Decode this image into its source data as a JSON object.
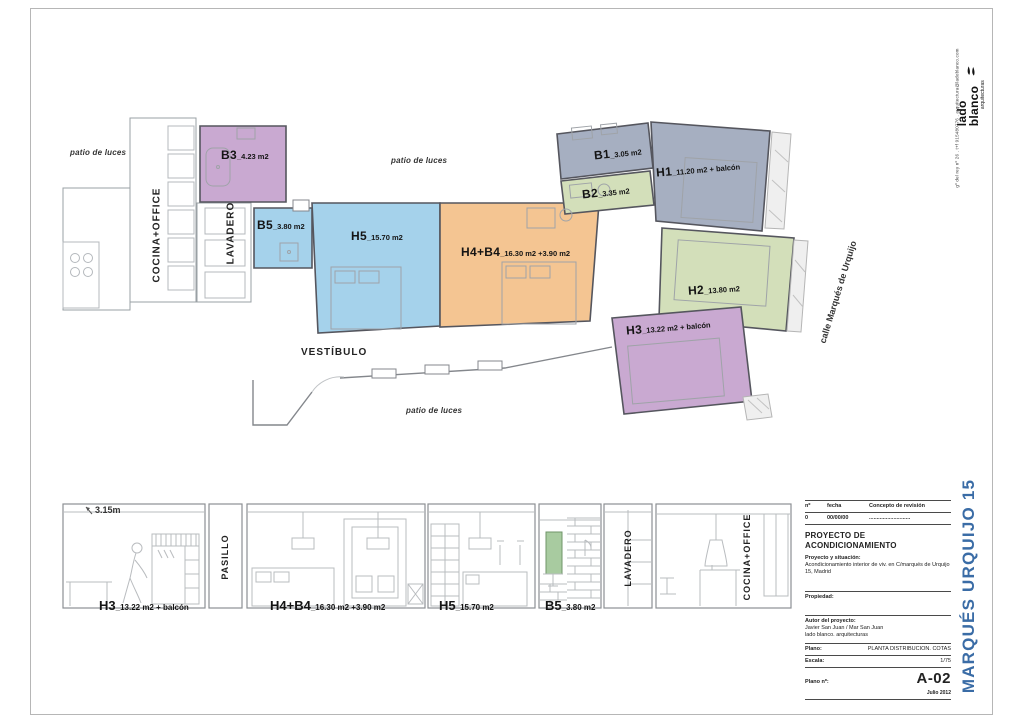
{
  "logo": {
    "title": "lado blanco",
    "subtitle": "arquitecturas",
    "contact": "gº del rey nº 26 . t+f 915480776 . arquitectura@ladoblanco.com"
  },
  "side_title": "MARQUÉS URQUIJO 15",
  "plan": {
    "labels": {
      "patio_left": "patio de luces",
      "patio_top": "patio de luces",
      "patio_bottom": "patio de luces",
      "cocina": "COCINA+OFFICE",
      "lavadero": "LAVADERO",
      "vestibulo": "VESTÍBULO",
      "calle": "calle Marqués de Urquijo"
    },
    "rooms": [
      {
        "code": "B3",
        "area": "_4.23 m2",
        "color": "#c9a9d1"
      },
      {
        "code": "B5",
        "area": "_3.80 m2",
        "color": "#a5d2eb"
      },
      {
        "code": "H5",
        "area": "_15.70 m2",
        "color": "#a5d2eb"
      },
      {
        "code": "H4+B4",
        "area": "_16.30 m2 +3.90 m2",
        "color": "#f4c592"
      },
      {
        "code": "B1",
        "area": "_3.05 m2",
        "color": "#a6afc1"
      },
      {
        "code": "B2",
        "area": "_3.35 m2",
        "color": "#d3dfba"
      },
      {
        "code": "H1",
        "area": "_11.20 m2 + balcón",
        "color": "#a6afc1"
      },
      {
        "code": "H2",
        "area": "_13.80 m2",
        "color": "#d3dfba"
      },
      {
        "code": "H3",
        "area": "_13.22 m2 + balcón",
        "color": "#c9a9d1"
      }
    ]
  },
  "elevations": {
    "dimension": "3.15m",
    "pasillo": "PASILLO",
    "lavadero": "LAVADERO",
    "cocina": "COCINA+OFFICE",
    "labels": [
      {
        "code": "H3",
        "area": "_13.22 m2 + balcón"
      },
      {
        "code": "H4+B4",
        "area": "_16.30 m2 +3.90 m2"
      },
      {
        "code": "H5",
        "area": "_15.70 m2"
      },
      {
        "code": "B5",
        "area": "_3.80 m2"
      }
    ]
  },
  "titleblock": {
    "rev_num_label": "nº",
    "rev_fecha_label": "fecha",
    "rev_concepto_label": "Concepto de revisión",
    "rev_num": "0",
    "rev_fecha": "00/00/00",
    "rev_concepto": "...........................",
    "project_title": "PROYECTO DE ACONDICIONAMIENTO",
    "situacion_label": "Proyecto y situación:",
    "situacion_value": "Acondicionamiento interior de viv. en C/marqués de Urquijo 15, Madrid",
    "propiedad_label": "Propiedad:",
    "autor_label": "Autor del proyecto:",
    "autor_line1": "Javier San Juan / Mar San Juan",
    "autor_line2": "lado blanco. arquitecturas",
    "plano_label": "Plano:",
    "plano_value": "PLANTA DISTRIBUCION. COTAS",
    "escala_label": "Escala:",
    "escala_value": "1/75",
    "plano_num_label": "Plano nº:",
    "plano_num_value": "A-02",
    "fecha_pie": "Julio 2012"
  },
  "colors": {
    "room_lilac": "#c9a9d1",
    "room_blue": "#a5d2eb",
    "room_orange": "#f4c592",
    "room_grayblue": "#a6afc1",
    "room_green": "#d3dfba",
    "accent_blue": "#3a6ca6"
  }
}
